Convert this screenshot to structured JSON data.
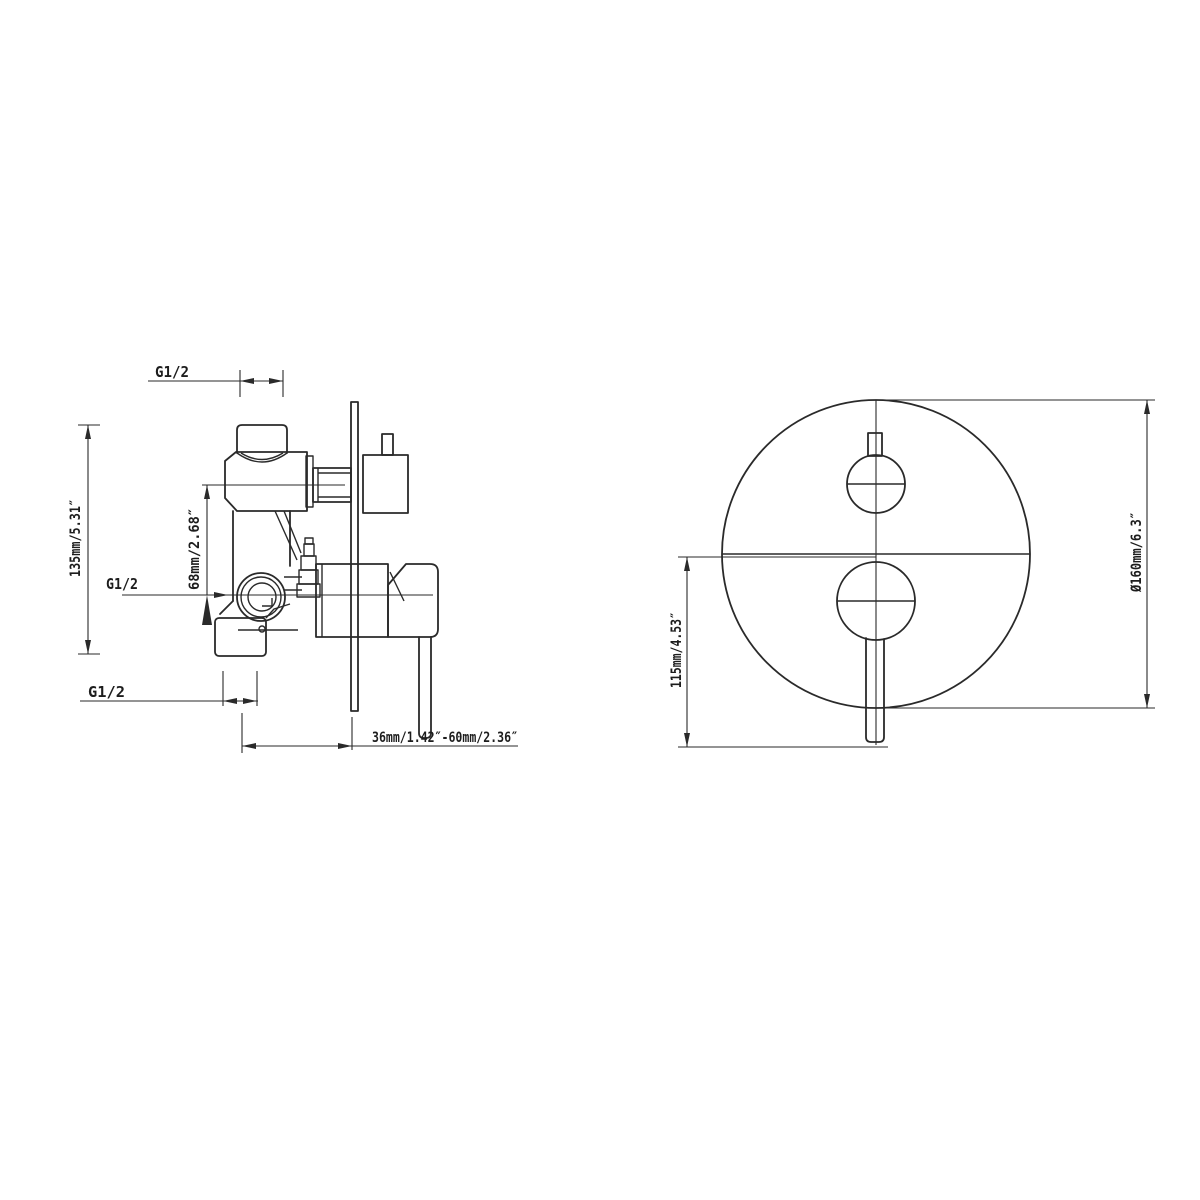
{
  "drawing": {
    "colors": {
      "line": "#2a2a2a",
      "background": "#ffffff"
    },
    "side_view": {
      "thread_label_top": "G1/2",
      "thread_label_middle": "G1/2",
      "thread_label_bottom": "G1/2",
      "dim_body_height": "135mm/5.31″",
      "dim_port_offset": "68mm/2.68″",
      "dim_install_depth": "36mm/1.42″-60mm/2.36″"
    },
    "front_view": {
      "dim_plate_diameter": "Ø160mm/6.3″",
      "dim_handle_drop": "115mm/4.53″"
    }
  }
}
